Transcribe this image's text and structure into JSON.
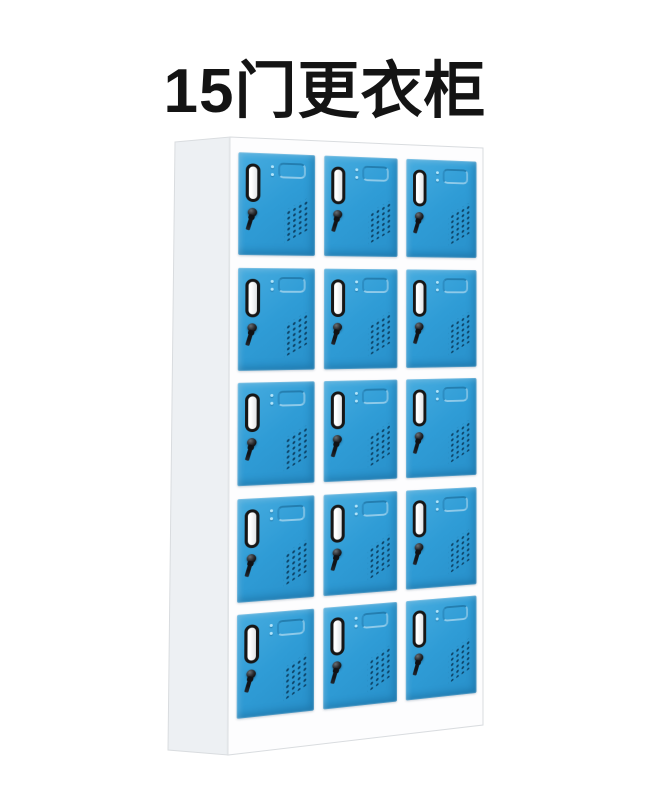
{
  "title": {
    "text": "15门更衣柜",
    "color": "#141414"
  },
  "locker": {
    "description": "white steel locker cabinet, 3D view with left side visible",
    "rows": 5,
    "columns": 3,
    "door_count": 15,
    "colors": {
      "title_color": "#141414",
      "door_blue": "#2F9CD6",
      "door_blue_light": "#47ACDF",
      "door_blue_dark": "#2890CA",
      "cabinet_white": "#FDFDFE",
      "side_panel": "#EDF0F3",
      "edge_line": "#D9DCDF",
      "slot_border": "#161616",
      "slot_fill": "#FFFFFF",
      "lock_black": "#0E0E10",
      "vent_dot": "#0A3C5E"
    },
    "door_features": [
      "name-card-slot",
      "recessed-handle",
      "lock-cylinder-with-key",
      "vent-holes"
    ],
    "doors": [
      {
        "row": 1,
        "col": 1
      },
      {
        "row": 1,
        "col": 2
      },
      {
        "row": 1,
        "col": 3
      },
      {
        "row": 2,
        "col": 1
      },
      {
        "row": 2,
        "col": 2
      },
      {
        "row": 2,
        "col": 3
      },
      {
        "row": 3,
        "col": 1
      },
      {
        "row": 3,
        "col": 2
      },
      {
        "row": 3,
        "col": 3
      },
      {
        "row": 4,
        "col": 1
      },
      {
        "row": 4,
        "col": 2
      },
      {
        "row": 4,
        "col": 3
      },
      {
        "row": 5,
        "col": 1
      },
      {
        "row": 5,
        "col": 2
      },
      {
        "row": 5,
        "col": 3
      }
    ]
  }
}
